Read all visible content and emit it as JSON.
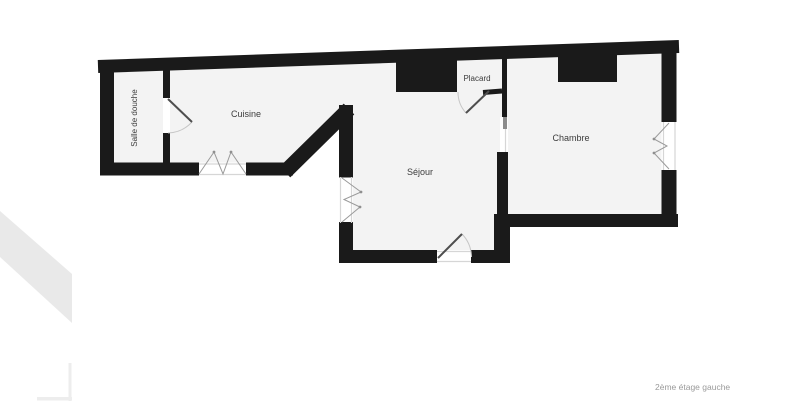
{
  "caption": "2ème étage gauche",
  "rooms": {
    "salle_de_douche": "Salle de douche",
    "cuisine": "Cuisine",
    "placard": "Placard",
    "sejour": "Séjour",
    "chambre": "Chambre"
  },
  "features": {
    "windows": [
      "cuisine-bottom-window",
      "sejour-left-window",
      "chambre-right-window"
    ],
    "doors": [
      "bathroom-door",
      "placard-door",
      "entry-door",
      "sejour-chambre-doorway"
    ],
    "duct_blocks": [
      "sejour-duct-block",
      "chambre-duct-block"
    ]
  },
  "colors": {
    "wall": "#1a1a1a",
    "room_fill": "#f3f3f3",
    "background": "#ffffff",
    "window_line": "#9a9a9a",
    "door_leaf": "#4e4e4e",
    "door_arc": "#c6c6c6",
    "label_text": "#3c3c3c",
    "caption_text": "#9a9a9a",
    "watermark": "#e9e9e9"
  }
}
